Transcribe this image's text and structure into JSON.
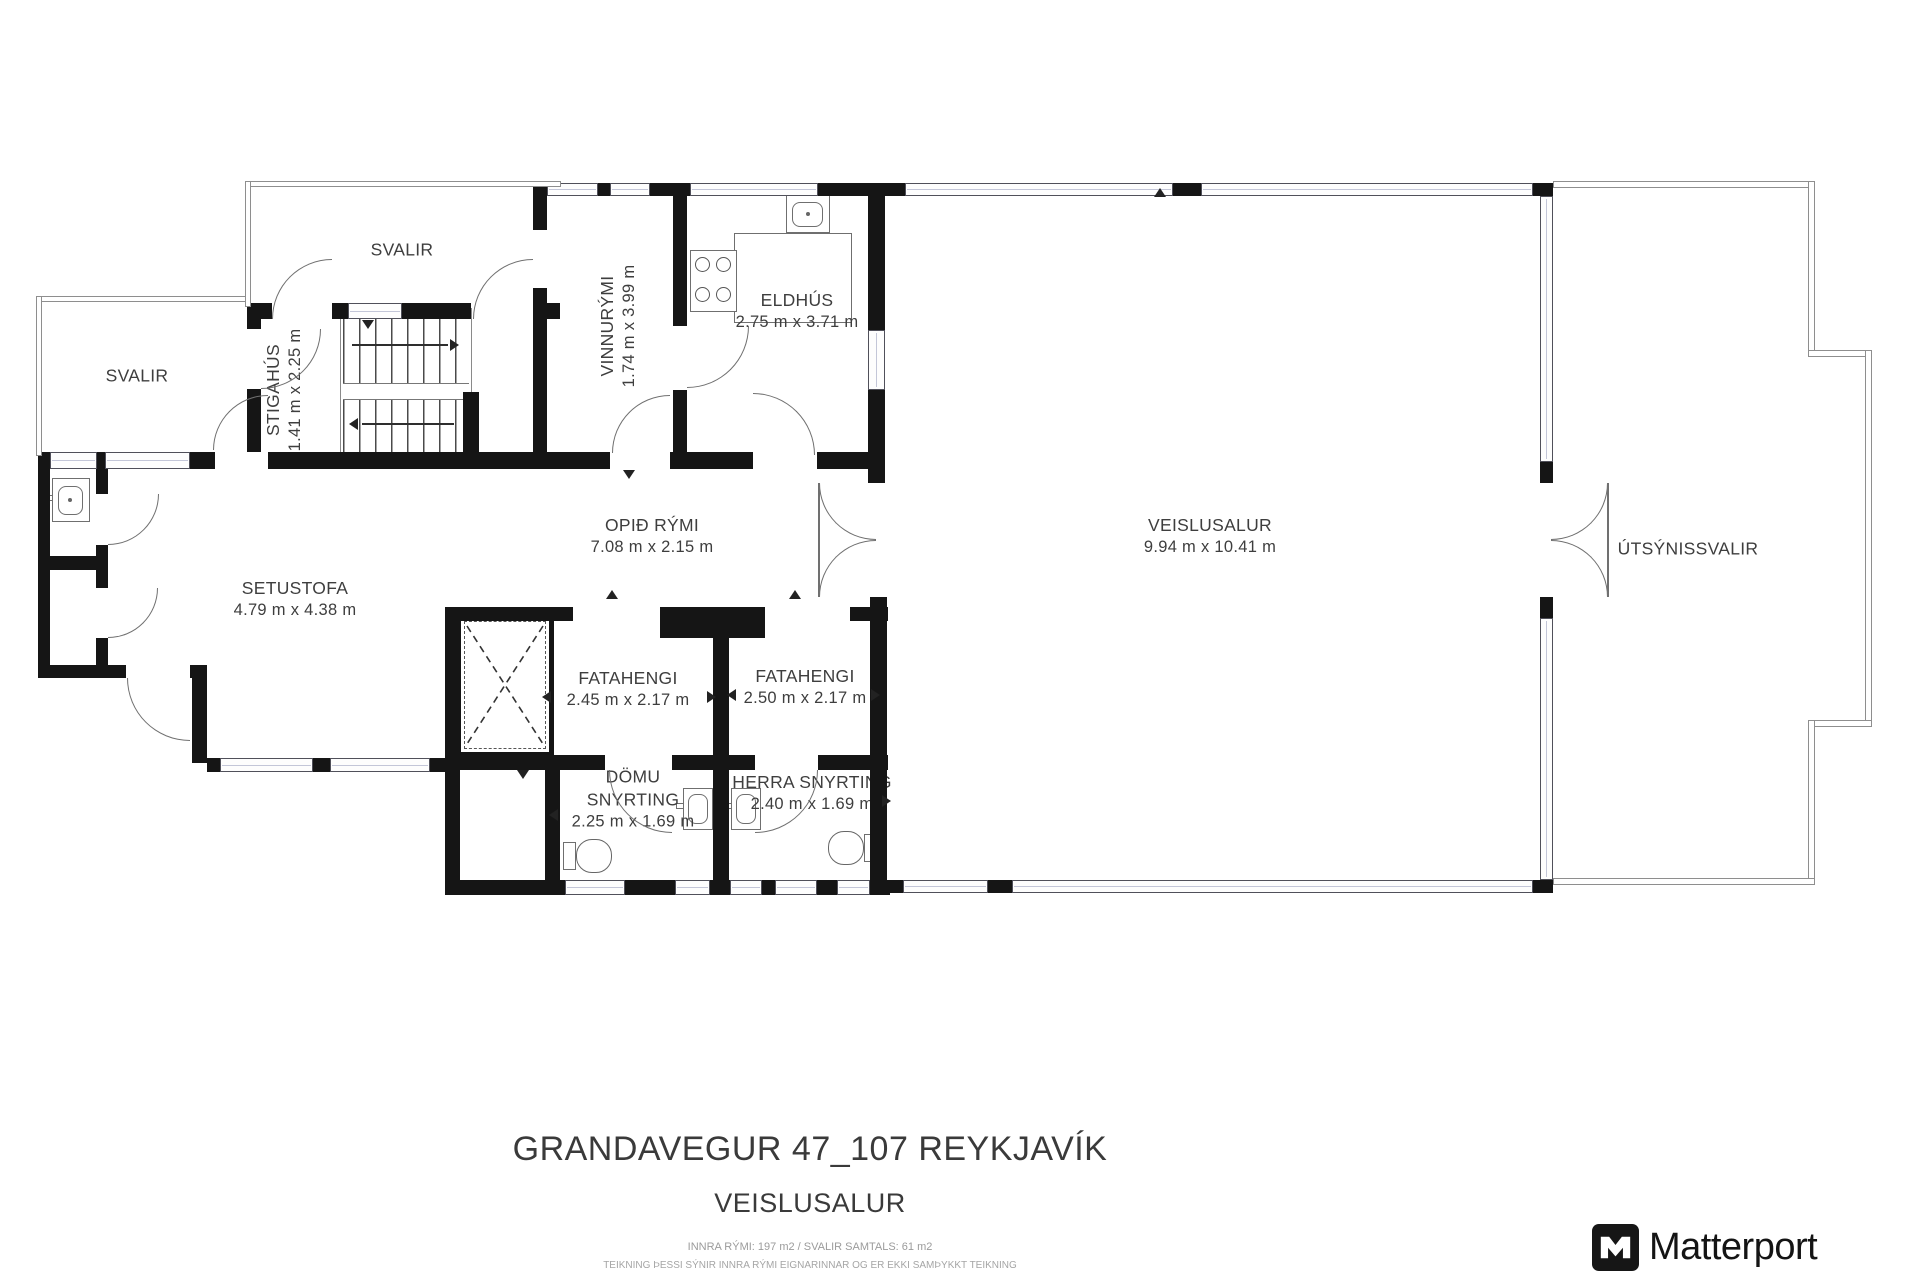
{
  "rooms": {
    "svalir_top": {
      "name": "SVALIR"
    },
    "svalir_left": {
      "name": "SVALIR"
    },
    "stigahus": {
      "name": "STIGAHÚS",
      "dims": "1.41 m x 2.25 m"
    },
    "vinnurymi": {
      "name": "VINNURÝMI",
      "dims": "1.74 m x 3.99 m"
    },
    "eldhus": {
      "name": "ELDHÚS",
      "dims": "2.75 m x 3.71 m"
    },
    "opid_rymi": {
      "name": "OPIÐ RÝMI",
      "dims": "7.08 m x 2.15 m"
    },
    "setustofa": {
      "name": "SETUSTOFA",
      "dims": "4.79 m x 4.38 m"
    },
    "veislusalur": {
      "name": "VEISLUSALUR",
      "dims": "9.94 m x 10.41 m"
    },
    "utsynissvalir": {
      "name": "ÚTSÝNISSVALIR"
    },
    "fatahengi_1": {
      "name": "FATAHENGI",
      "dims": "2.45 m x 2.17 m"
    },
    "fatahengi_2": {
      "name": "FATAHENGI",
      "dims": "2.50 m x 2.17 m"
    },
    "domu_snyrting": {
      "name": "DÖMU SNYRTING",
      "dims": "2.25 m x 1.69 m"
    },
    "herra_snyrting": {
      "name": "HERRA SNYRTING",
      "dims": "2.40 m x 1.69 m"
    }
  },
  "title": {
    "address": "GRANDAVEGUR 47_107 REYKJAVÍK",
    "floor_name": "VEISLUSALUR",
    "area_line": "INNRA RÝMI: 197 m2  /  SVALIR SAMTALS: 61 m2",
    "disclaimer": "TEIKNING ÞESSI SÝNIR INNRA RÝMI EIGNARINNAR OG ER EKKI SAMÞYKKT TEIKNING"
  },
  "branding": {
    "logo_text": "Matterport"
  },
  "colors": {
    "wall": "#151515",
    "label": "#3e3e3e",
    "railing": "#8e8e8e",
    "window_tint": "#c3c6d8"
  }
}
